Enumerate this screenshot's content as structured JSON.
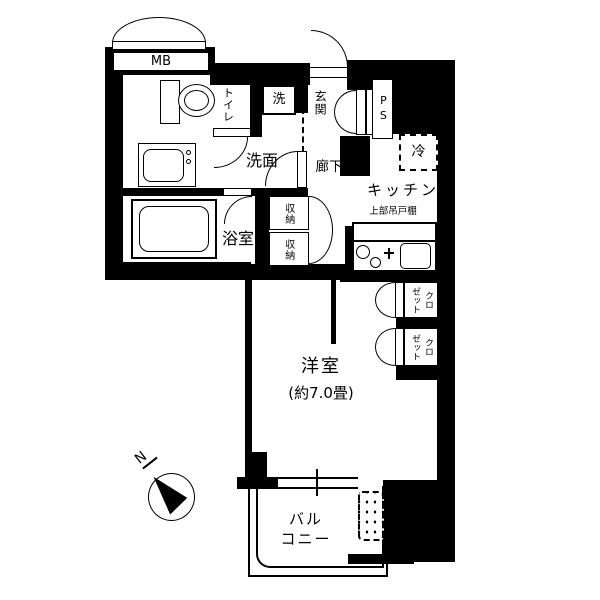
{
  "plan": {
    "title": "apartment-floor-plan",
    "colors": {
      "wall": "#000000",
      "background": "#ffffff"
    },
    "rooms": {
      "meter_box": "MB",
      "toilet": "トイレ",
      "washer": "洗",
      "entrance": "玄関",
      "pipe_space": "PS",
      "washroom": "洗面",
      "corridor": "廊下",
      "fridge": "冷",
      "kitchen": "キッチン",
      "upper_cupboard": "上部吊戸棚",
      "bathroom": "浴室",
      "storage_top": "収納",
      "storage_bottom": "収納",
      "closet_top": "クロ\nゼット",
      "closet_bottom": "クロ\nゼット",
      "western_room": "洋室",
      "western_room_size": "(約7.0畳)",
      "balcony": "バル\nコニー",
      "north": "N"
    }
  }
}
